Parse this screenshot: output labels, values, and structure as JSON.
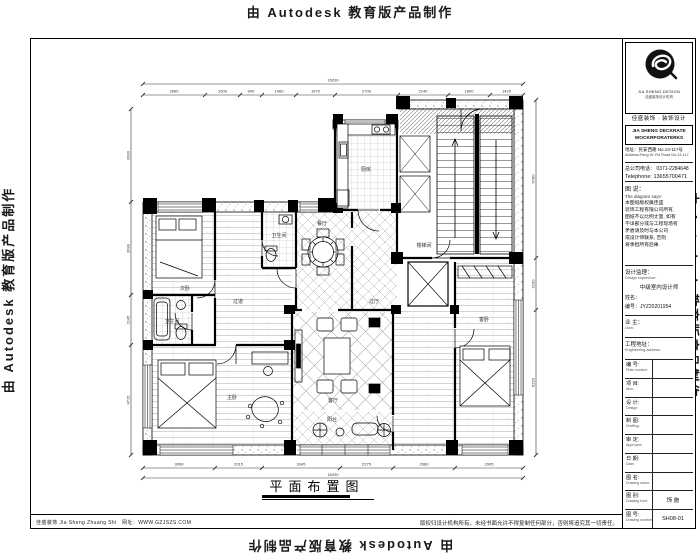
{
  "watermark": {
    "text": "由 Autodesk 教育版产品制作"
  },
  "plan": {
    "title": "平面布置图",
    "rooms": [
      {
        "label": "次卧"
      },
      {
        "label": "卫生间"
      },
      {
        "label": "过道"
      },
      {
        "label": "卫生间"
      },
      {
        "label": "餐厅"
      },
      {
        "label": "厨房"
      },
      {
        "label": "过厅"
      },
      {
        "label": "客厅"
      },
      {
        "label": "主卧"
      },
      {
        "label": "客卧"
      },
      {
        "label": "阳台"
      },
      {
        "label": "楼梯间"
      }
    ],
    "dims": {
      "top_overall": "16290",
      "top": [
        "2660",
        "1500",
        "940",
        "1460",
        "1670",
        "2700",
        "2140",
        "1800",
        "1420"
      ],
      "bottom_overall": "16290",
      "bottom": [
        "3090",
        "2015",
        "3345",
        "2275",
        "2660",
        "2905"
      ],
      "left": [
        "3990",
        "3990",
        "2145",
        "4715"
      ],
      "right": [
        "6780",
        "2230",
        "6220"
      ]
    }
  },
  "title_block": {
    "logo_caption": "JIA SHENG DESIGN",
    "logo_sub": "佳盛装饰设计机构",
    "company_cn": "佳盛装饰 · 装饰设计",
    "company_en_1": "JIA SHENG DECKRATE",
    "company_en_2": "WOCKRPORATERKS",
    "address_cn": "地址：民安西路 No.13-117号",
    "address_en": "Address:Fang W. Rd Road No.13-117",
    "phone_cn": "总公司电话： 0371-2284648",
    "phone_en": "Telephone: 13655700471",
    "notice_label_cn": "图 说：",
    "notice_label_en": "The diagram says:",
    "notice_lines": [
      "本图纸版权属佳盛",
      "装饰工程有限公司所有,",
      "图纸不以比例丈量, 如有",
      "不详部分或与工程现场有",
      "矛盾请及时与本公司",
      "或设计师联系, 否则",
      "将承担所有后果."
    ],
    "designer_label": "设计监理：",
    "designer_label_en": "Design supervisor:",
    "designer_title": "中级室内设计师",
    "designer_name_label": "姓名：",
    "designer_no": "编号：JYZ20201954",
    "owner_label": "业 主：",
    "owner_label_en": "Own:",
    "site_label": "工程地址：",
    "site_label_en": "Engineering address:",
    "table": [
      {
        "cn": "编 号:",
        "en": "Plate number:",
        "value": ""
      },
      {
        "cn": "项 目:",
        "en": "Item:",
        "value": ""
      },
      {
        "cn": "设 计:",
        "en": "Design:",
        "value": ""
      },
      {
        "cn": "制 图:",
        "en": "Drafting:",
        "value": ""
      },
      {
        "cn": "审 定:",
        "en": "Approved:",
        "value": ""
      },
      {
        "cn": "日 期:",
        "en": "Date:",
        "value": ""
      },
      {
        "cn": "图 名:",
        "en": "Drawing name:",
        "value": ""
      },
      {
        "cn": "图 别:",
        "en": "Drawing kind:",
        "value": "饰 施"
      },
      {
        "cn": "图 号:",
        "en": "Drawing number:",
        "value": "SH08-01"
      }
    ]
  },
  "footer": {
    "left": "佳盛装饰 Jia Sheng Zhuang Shi　网址：WWW.GZJSZS.COM",
    "right": "版权归设计机构所有，未经书面允许不得复制任何部分，否则将追究其一切责任。"
  }
}
